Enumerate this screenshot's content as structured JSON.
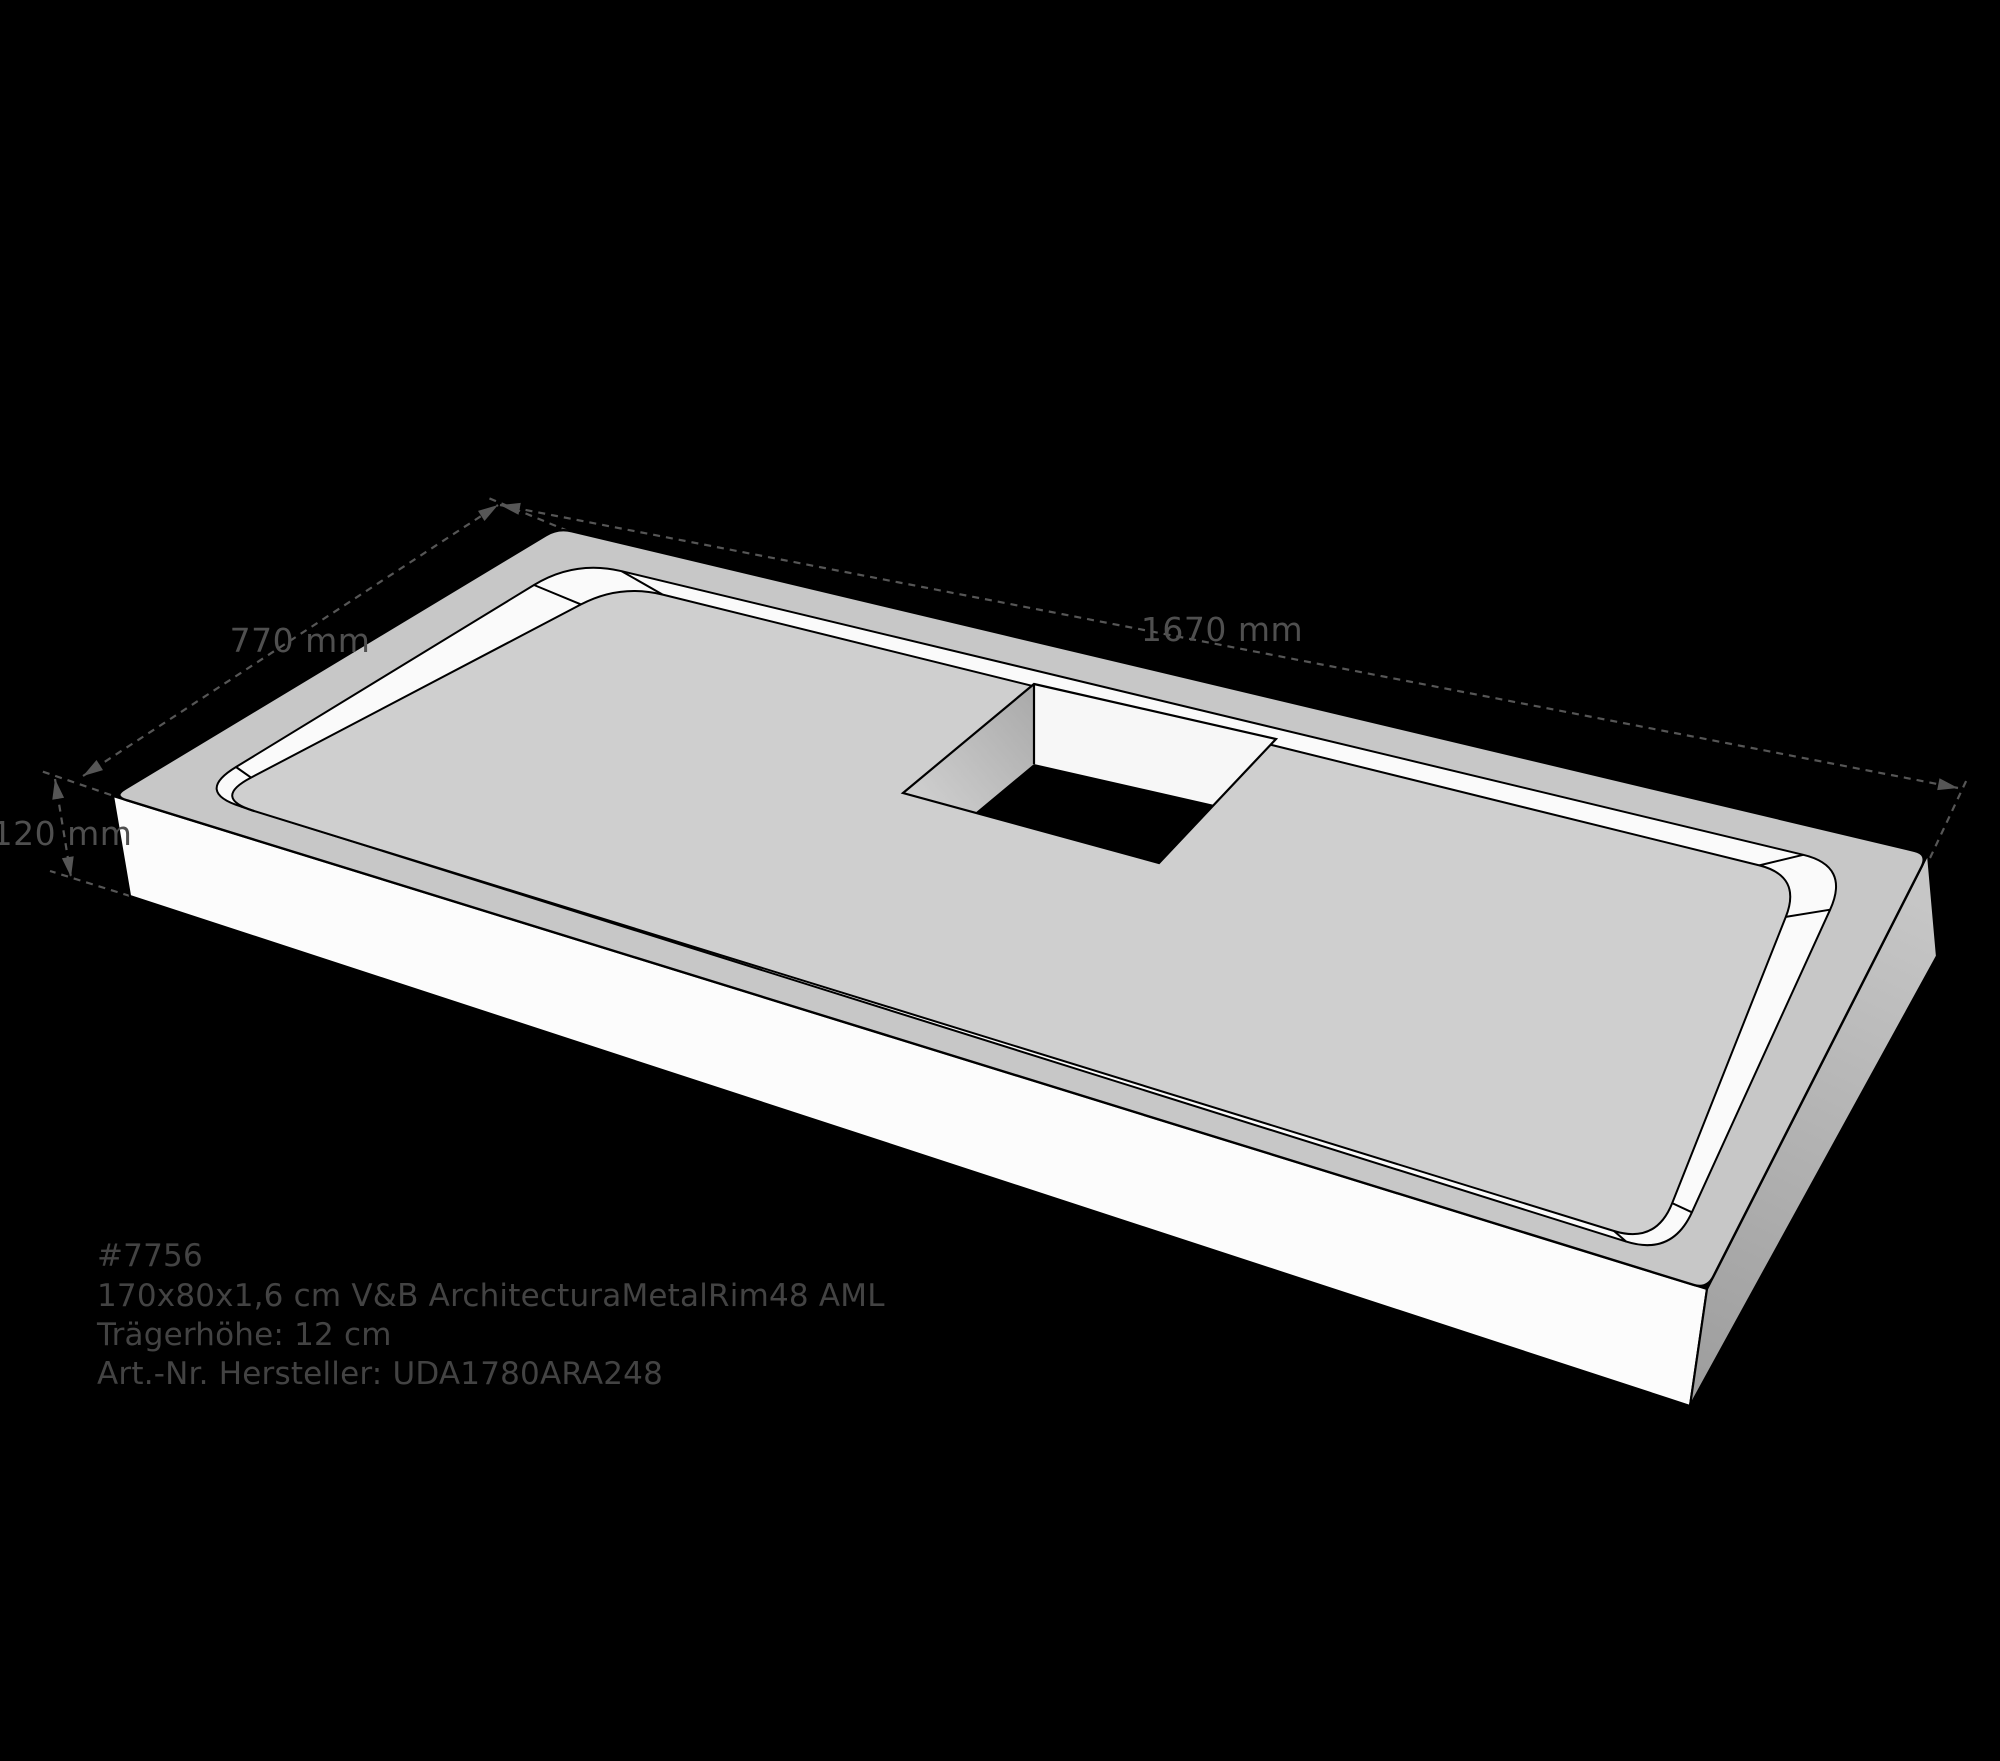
{
  "scene": {
    "kind": "technical-3d-drawing",
    "subject_visible": "rectangular tray support with central square cutout"
  },
  "dimensions": {
    "length_label": "1670 mm",
    "width_label": "770 mm",
    "height_label": "120 mm"
  },
  "info_block": {
    "line1": "#7756",
    "line2": "170x80x1,6 cm V&B ArchitecturaMetalRim48 AML",
    "line3": "Trägerhöhe: 12 cm",
    "line4": "Art.-Nr. Hersteller: UDA1780ARA248"
  },
  "colors": {
    "background": "#000000",
    "top_face": "#c7c7c7",
    "floor": "#cfcfcf",
    "channel": "#fafafa",
    "front_left_face": "#fcfcfc",
    "front_right_face_light": "#c6c6c6",
    "front_right_face_dark": "#9d9d9d",
    "hole_interior": "#000000",
    "hole_wall_left_light": "#d0d0d0",
    "hole_wall_left_dark": "#a9a9a9",
    "hole_wall_back": "#f7f7f7",
    "edge": "#000000",
    "dimension_lines": "#565656",
    "dimension_text": "#4f4f4f",
    "info_text": "#434343"
  }
}
